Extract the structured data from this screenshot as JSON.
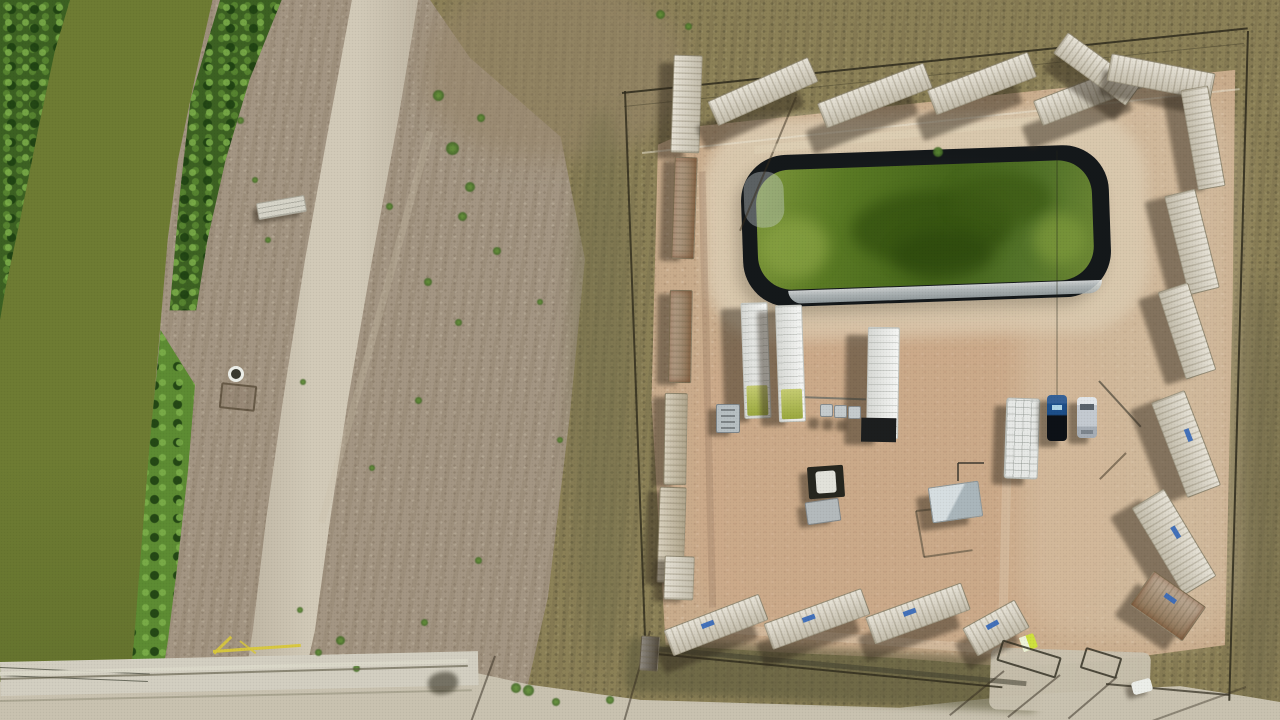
{
  "meta": {
    "description": "Aerial drone photograph, top-down view: a fenced rectangular industrial well pad on the right enclosed by tan shipping containers arranged in a sawtooth pattern, containing a black-lined retention pond of green water, white equipment trailers, a pickup truck and SUV, sheds and gates; on the left an olive-green irrigation canal bordered by vegetation, a dirt road, barren scrubby fields, a concrete bridge and a yellow gate at bottom left."
  },
  "colors": {
    "field": "#a49683",
    "scrub": "#8c8157",
    "scrub-dark": "#6f684a",
    "scrub-brown": "#97866a",
    "canal-water": "#6e7c33",
    "canal-water-dark": "#5f6e2b",
    "veg-dark": "#3c6122",
    "veg-bright": "#5d8c33",
    "road": "#c9c2b0",
    "road-light": "#d2cab8",
    "concrete": "#d3cfc1",
    "pad": "#c9ac8c",
    "pad-light": "#dbc9ae",
    "pad-pink": "#cfa887",
    "apron": "#decfb6",
    "pond-liner": "#14181a",
    "pond-water": "#46661b",
    "pond-water-light": "#8aa344",
    "pond-water-dark": "#33500f",
    "silver-liner": "#c9d0d1",
    "container-cream": "#d9d2bf",
    "container-tan": "#c5b99d",
    "container-rust": "#9c7f5e",
    "trailer-white": "#eceeea",
    "tank-green": "#9aa83e",
    "rv-white": "#e7e9e6",
    "car-blue": "#1d4f8a",
    "car-silver": "#c4cad1",
    "porta": "#cfe13e",
    "gate-yellow": "#d9c83b",
    "shed-grey": "#aab6bb",
    "equip-grey": "#c5cbcd",
    "label-blue": "#3b6cb8",
    "fence": "#2e2a1c"
  },
  "scene": {
    "objects": [
      {
        "name": "container-top-a",
        "cls": "cont vert cream",
        "x": 672,
        "y": 55,
        "w": 27,
        "h": 96,
        "rot": 2,
        "sx": -14,
        "sy": 8
      },
      {
        "name": "container-top-b",
        "cls": "cont cream",
        "x": 708,
        "y": 78,
        "w": 108,
        "h": 25,
        "rot": -24,
        "sx": -12,
        "sy": 26
      },
      {
        "name": "container-top-c",
        "cls": "cont cream",
        "x": 818,
        "y": 82,
        "w": 112,
        "h": 25,
        "rot": -21,
        "sx": -12,
        "sy": 28
      },
      {
        "name": "container-top-d",
        "cls": "cont cream",
        "x": 928,
        "y": 70,
        "w": 106,
        "h": 25,
        "rot": -21,
        "sx": -12,
        "sy": 28
      },
      {
        "name": "container-top-e",
        "cls": "cont cream",
        "x": 1034,
        "y": 80,
        "w": 110,
        "h": 25,
        "rot": -21,
        "sx": -12,
        "sy": 26
      },
      {
        "name": "container-top-f",
        "cls": "cont cream",
        "x": 1052,
        "y": 56,
        "w": 88,
        "h": 24,
        "rot": 36,
        "sx": -10,
        "sy": 18
      },
      {
        "name": "container-top-g",
        "cls": "cont cream",
        "x": 1108,
        "y": 63,
        "w": 104,
        "h": 26,
        "rot": 11,
        "sx": -8,
        "sy": 16
      },
      {
        "name": "container-right-1",
        "cls": "cont cream",
        "x": 1152,
        "y": 124,
        "w": 100,
        "h": 26,
        "rot": 80,
        "sx": -18,
        "sy": 6
      },
      {
        "name": "container-right-2",
        "cls": "cont cream",
        "x": 1141,
        "y": 226,
        "w": 100,
        "h": 30,
        "rot": 76,
        "sx": -20,
        "sy": 6
      },
      {
        "name": "container-right-3",
        "cls": "cont cream",
        "x": 1141,
        "y": 315,
        "w": 90,
        "h": 30,
        "rot": 72,
        "sx": -20,
        "sy": 8
      },
      {
        "name": "container-right-4",
        "cls": "cont cream label",
        "x": 1135,
        "y": 426,
        "w": 100,
        "h": 34,
        "rot": 69,
        "sx": -22,
        "sy": 8
      },
      {
        "name": "container-right-5",
        "cls": "cont cream label",
        "x": 1123,
        "y": 523,
        "w": 100,
        "h": 36,
        "rot": 59,
        "sx": -22,
        "sy": 10
      },
      {
        "name": "container-right-6",
        "cls": "cont rust label",
        "x": 1136,
        "y": 585,
        "w": 62,
        "h": 40,
        "rot": 35,
        "sx": -16,
        "sy": 12
      },
      {
        "name": "container-left-2",
        "cls": "cont vert rust",
        "x": 673,
        "y": 157,
        "w": 21,
        "h": 100,
        "rot": 2,
        "sx": -12,
        "sy": 4
      },
      {
        "name": "container-left-3",
        "cls": "cont vert rust",
        "x": 669,
        "y": 290,
        "w": 21,
        "h": 91,
        "rot": 1,
        "sx": -12,
        "sy": 4
      },
      {
        "name": "container-left-4",
        "cls": "cont vert tan",
        "x": 664,
        "y": 393,
        "w": 21,
        "h": 90,
        "rot": 1,
        "sx": -12,
        "sy": 4
      },
      {
        "name": "container-left-5",
        "cls": "cont vert tan",
        "x": 658,
        "y": 487,
        "w": 25,
        "h": 94,
        "rot": 2,
        "sx": -12,
        "sy": 4
      },
      {
        "name": "container-left-6",
        "cls": "cont vert cream",
        "x": 664,
        "y": 556,
        "w": 28,
        "h": 42,
        "rot": 2,
        "sx": -10,
        "sy": 4
      },
      {
        "name": "container-left-7",
        "cls": "cont vert darkc",
        "x": 640,
        "y": 636,
        "w": 17,
        "h": 33,
        "rot": 4
      },
      {
        "name": "container-bottom-1",
        "cls": "cont cream label",
        "x": 665,
        "y": 611,
        "w": 100,
        "h": 26,
        "rot": -21,
        "sx": -8,
        "sy": 20
      },
      {
        "name": "container-bottom-2",
        "cls": "cont cream label",
        "x": 765,
        "y": 605,
        "w": 102,
        "h": 26,
        "rot": -20,
        "sx": -8,
        "sy": 20
      },
      {
        "name": "container-bottom-3",
        "cls": "cont cream label",
        "x": 867,
        "y": 599,
        "w": 100,
        "h": 27,
        "rot": -20,
        "sx": -8,
        "sy": 20
      },
      {
        "name": "container-bottom-4",
        "cls": "cont cream label",
        "x": 966,
        "y": 612,
        "w": 58,
        "h": 30,
        "rot": -29,
        "sx": -8,
        "sy": 16
      },
      {
        "name": "equipment-trailer-1",
        "cls": "trailer tank",
        "x": 698,
        "y": 347,
        "w": 114,
        "h": 25,
        "rot": 88,
        "sx": -20,
        "sy": 6
      },
      {
        "name": "equipment-trailer-2",
        "cls": "trailer tank",
        "x": 732,
        "y": 350,
        "w": 115,
        "h": 25,
        "rot": 88,
        "sx": -18,
        "sy": 6
      },
      {
        "name": "equipment-trailer-3",
        "cls": "trailer darkend",
        "x": 827,
        "y": 367,
        "w": 110,
        "h": 30,
        "rot": 91,
        "sx": -22,
        "sy": 8
      },
      {
        "name": "rv-trailer",
        "cls": "rv",
        "x": 1005,
        "y": 398,
        "w": 32,
        "h": 79,
        "rot": 2,
        "sx": -12,
        "sy": 8
      },
      {
        "name": "pickup-truck",
        "cls": "pickup",
        "x": 1047,
        "y": 395,
        "w": 20,
        "h": 46,
        "rot": 0,
        "sx": -9,
        "sy": 6
      },
      {
        "name": "suv-car",
        "cls": "suv",
        "x": 1077,
        "y": 397,
        "w": 20,
        "h": 41,
        "rot": 0,
        "sx": -9,
        "sy": 6
      },
      {
        "name": "junction-box",
        "cls": "junction",
        "x": 808,
        "y": 466,
        "w": 36,
        "h": 32,
        "rot": -4,
        "sx": -8,
        "sy": 6
      },
      {
        "name": "equipment-unit",
        "cls": "unit",
        "x": 806,
        "y": 500,
        "w": 32,
        "h": 21,
        "rot": -8,
        "sx": -8,
        "sy": 5
      },
      {
        "name": "equipment-skid",
        "cls": "skid",
        "x": 716,
        "y": 404,
        "w": 22,
        "h": 27,
        "rot": 0,
        "sx": -8,
        "sy": 5
      },
      {
        "name": "metal-shed",
        "cls": "shed",
        "x": 930,
        "y": 484,
        "w": 49,
        "h": 34,
        "rot": -8,
        "sx": -12,
        "sy": 10
      },
      {
        "name": "small-tank-1",
        "cls": "tank-s",
        "x": 820,
        "y": 404,
        "w": 11,
        "h": 11,
        "rot": 0,
        "sx": -12,
        "sy": 14
      },
      {
        "name": "small-tank-2",
        "cls": "tank-s",
        "x": 834,
        "y": 405,
        "w": 11,
        "h": 11,
        "rot": 0,
        "sx": -12,
        "sy": 14
      },
      {
        "name": "small-tank-3",
        "cls": "tank-s",
        "x": 848,
        "y": 406,
        "w": 11,
        "h": 11,
        "rot": 0,
        "sx": -12,
        "sy": 14
      },
      {
        "name": "porta-potty",
        "cls": "porta",
        "x": 1021,
        "y": 635,
        "w": 15,
        "h": 15,
        "rot": -20
      },
      {
        "name": "culvert-slab",
        "cls": "slab",
        "x": 257,
        "y": 199,
        "w": 47,
        "h": 15,
        "rot": -10,
        "sx": -4,
        "sy": 6
      },
      {
        "name": "culvert-ring",
        "cls": "ring",
        "x": 228,
        "y": 366,
        "w": 10,
        "h": 10,
        "rot": 0
      },
      {
        "name": "livestock-pen",
        "cls": "pen",
        "x": 220,
        "y": 384,
        "w": 32,
        "h": 22,
        "rot": 6
      },
      {
        "name": "white-car-south",
        "cls": "whitecar",
        "x": 1132,
        "y": 680,
        "w": 20,
        "h": 13,
        "rot": -15,
        "sx": -6,
        "sy": 4
      },
      {
        "name": "culvert-shadow",
        "cls": "darkpatch",
        "x": 428,
        "y": 672,
        "w": 30,
        "h": 22,
        "rot": -10
      },
      {
        "name": "entrance-gate-left",
        "cls": "gate",
        "x": 998,
        "y": 648,
        "w": 58,
        "h": 18,
        "rot": 17
      },
      {
        "name": "entrance-gate-right",
        "cls": "gate",
        "x": 1082,
        "y": 652,
        "w": 34,
        "h": 18,
        "rot": 17
      }
    ],
    "lines": [
      {
        "name": "fence-north",
        "x": 622,
        "y": 92,
        "len": 629,
        "rot": -5.9,
        "w": 2,
        "color": "#2e2a1c",
        "op": 0.85
      },
      {
        "name": "fence-north-inner",
        "x": 624,
        "y": 106,
        "len": 623,
        "rot": -5.8,
        "w": 1,
        "color": "#2e2a1c",
        "op": 0.35
      },
      {
        "name": "track-inner-north",
        "x": 642,
        "y": 152,
        "len": 601,
        "rot": -6.1,
        "w": 2,
        "color": "#ebe6d4",
        "op": 0.5
      },
      {
        "name": "fence-west",
        "x": 625,
        "y": 90,
        "len": 566,
        "rot": 87.9,
        "w": 2,
        "color": "#2e2a1c",
        "op": 0.8
      },
      {
        "name": "fence-east",
        "x": 1248,
        "y": 30,
        "len": 670,
        "rot": 91.6,
        "w": 2,
        "color": "#2e2a1c",
        "op": 0.85
      },
      {
        "name": "fence-south-left",
        "x": 646,
        "y": 652,
        "len": 358,
        "rot": 5.5,
        "w": 2,
        "color": "#2e2a1c",
        "op": 0.8
      },
      {
        "name": "fence-south-right",
        "x": 1106,
        "y": 683,
        "len": 124,
        "rot": 5.1,
        "w": 2,
        "color": "#2e2a1c",
        "op": 0.7
      },
      {
        "name": "south-pipe",
        "x": 654,
        "y": 646,
        "len": 374,
        "rot": 5.4,
        "w": 5,
        "color": "#423f2f",
        "op": 0.55
      },
      {
        "name": "guy-cable",
        "x": 1057,
        "y": 150,
        "len": 284,
        "rot": 90,
        "w": 1,
        "color": "#23251a",
        "op": 0.5
      },
      {
        "name": "pole-shadow-north",
        "x": 796,
        "y": 96,
        "len": 145,
        "rot": 112.7,
        "w": 2,
        "color": "#372d1e",
        "op": 0.5
      },
      {
        "name": "pole-shadow-cars",
        "x": 1126,
        "y": 452,
        "len": 37,
        "rot": 135,
        "w": 2,
        "color": "#372d1e",
        "op": 0.5
      },
      {
        "name": "pipe-northeast",
        "x": 1099,
        "y": 380,
        "len": 62,
        "rot": 47.6,
        "w": 2,
        "color": "#35332a",
        "op": 0.6
      },
      {
        "name": "gate-shadow-1",
        "x": 1004,
        "y": 670,
        "len": 70,
        "rot": 140.8,
        "w": 2,
        "color": "#322a1e",
        "op": 0.5
      },
      {
        "name": "gate-shadow-2",
        "x": 1060,
        "y": 674,
        "len": 67,
        "rot": 141,
        "w": 2,
        "color": "#322a1e",
        "op": 0.5
      },
      {
        "name": "gate-shadow-3",
        "x": 1117,
        "y": 676,
        "len": 64,
        "rot": 139.4,
        "w": 2,
        "color": "#322a1e",
        "op": 0.5
      },
      {
        "name": "gate-shadow-4",
        "x": 1246,
        "y": 686,
        "len": 100,
        "rot": 160.1,
        "w": 2,
        "color": "#322a1e",
        "op": 0.4
      },
      {
        "name": "pole-shadow-road-1",
        "x": 495,
        "y": 655,
        "len": 70,
        "rot": 110,
        "w": 2,
        "color": "#322a1e",
        "op": 0.5
      },
      {
        "name": "pole-shadow-road-2",
        "x": 650,
        "y": 630,
        "len": 95,
        "rot": 106,
        "w": 2,
        "color": "#322a1e",
        "op": 0.5
      },
      {
        "name": "power-line-1",
        "x": 0,
        "y": 667,
        "len": 150,
        "rot": 2.5,
        "w": 1,
        "color": "#232719",
        "op": 0.6
      },
      {
        "name": "power-line-2",
        "x": 0,
        "y": 675,
        "len": 148,
        "rot": 2.3,
        "w": 1,
        "color": "#232719",
        "op": 0.6
      },
      {
        "name": "bridge-guardrail-light",
        "x": 0,
        "y": 672,
        "len": 468,
        "rot": -1.6,
        "w": 4,
        "color": "#dcd8ca",
        "op": 0.9
      },
      {
        "name": "bridge-guardrail-dark",
        "x": 0,
        "y": 678,
        "len": 468,
        "rot": -1.6,
        "w": 2,
        "color": "#5c5742",
        "op": 0.6
      },
      {
        "name": "bridge-edge",
        "x": 0,
        "y": 700,
        "len": 472,
        "rot": -1.3,
        "w": 2,
        "color": "#97927f",
        "op": 0.6
      },
      {
        "name": "yellow-gate-bar",
        "x": 213,
        "y": 650,
        "len": 88,
        "rot": -4,
        "w": 3,
        "color": "#d9c83b",
        "op": 0.95
      },
      {
        "name": "yellow-gate-arm-1",
        "x": 214,
        "y": 652,
        "len": 24,
        "rot": -44,
        "w": 3,
        "color": "#d9c83b",
        "op": 0.9
      },
      {
        "name": "yellow-gate-arm-2",
        "x": 240,
        "y": 640,
        "len": 20,
        "rot": 38,
        "w": 2,
        "color": "#d9c83b",
        "op": 0.8
      },
      {
        "name": "field-trail",
        "x": 430,
        "y": 128,
        "len": 406,
        "rot": 105.5,
        "w": 7,
        "color": "#cdc3ac",
        "op": 0.28
      },
      {
        "name": "pad-track-north",
        "x": 754,
        "y": 146,
        "len": 327,
        "rot": -6,
        "w": 8,
        "color": "#e4d6bc",
        "op": 0.4
      },
      {
        "name": "pad-track-south",
        "x": 700,
        "y": 622,
        "len": 302,
        "rot": 4.5,
        "w": 9,
        "color": "#e4d6bc",
        "op": 0.33
      },
      {
        "name": "pad-track-gate",
        "x": 1002,
        "y": 652,
        "len": 235,
        "rot": -88.5,
        "w": 9,
        "color": "#e0d2b8",
        "op": 0.33
      },
      {
        "name": "pad-track-west",
        "x": 702,
        "y": 168,
        "len": 436,
        "rot": 88.6,
        "w": 7,
        "color": "#96785f",
        "op": 0.3
      },
      {
        "name": "shed-frame-1",
        "x": 916,
        "y": 510,
        "len": 52,
        "rot": -6,
        "w": 2,
        "color": "#3f3b2e",
        "op": 0.5
      },
      {
        "name": "shed-frame-2",
        "x": 916,
        "y": 510,
        "len": 47,
        "rot": 80,
        "w": 2,
        "color": "#3f3b2e",
        "op": 0.5
      },
      {
        "name": "shed-frame-3",
        "x": 924,
        "y": 556,
        "len": 49,
        "rot": -8,
        "w": 2,
        "color": "#3f3b2e",
        "op": 0.5
      },
      {
        "name": "l-pipe-1",
        "x": 958,
        "y": 462,
        "len": 26,
        "rot": 0,
        "w": 2,
        "color": "#33312a",
        "op": 0.7
      },
      {
        "name": "l-pipe-2",
        "x": 958,
        "y": 462,
        "len": 18,
        "rot": 90,
        "w": 2,
        "color": "#33312a",
        "op": 0.7
      },
      {
        "name": "manifold-pipe",
        "x": 798,
        "y": 396,
        "len": 68,
        "rot": 2,
        "w": 2,
        "color": "#6b6e66",
        "op": 0.8
      }
    ],
    "bushes": [
      [
        438,
        95,
        11
      ],
      [
        452,
        148,
        13
      ],
      [
        470,
        187,
        10
      ],
      [
        481,
        118,
        8
      ],
      [
        462,
        216,
        9
      ],
      [
        497,
        251,
        8
      ],
      [
        389,
        206,
        7
      ],
      [
        428,
        282,
        8
      ],
      [
        458,
        322,
        7
      ],
      [
        540,
        302,
        6
      ],
      [
        418,
        400,
        7
      ],
      [
        372,
        468,
        6
      ],
      [
        303,
        382,
        6
      ],
      [
        478,
        560,
        7
      ],
      [
        340,
        640,
        9
      ],
      [
        424,
        622,
        7
      ],
      [
        516,
        688,
        10
      ],
      [
        560,
        440,
        6
      ],
      [
        528,
        690,
        11
      ],
      [
        556,
        702,
        8
      ],
      [
        610,
        700,
        8
      ],
      [
        318,
        652,
        7
      ],
      [
        356,
        668,
        7
      ],
      [
        300,
        610,
        6
      ],
      [
        660,
        14,
        9
      ],
      [
        688,
        26,
        7
      ],
      [
        240,
        120,
        7
      ],
      [
        255,
        180,
        6
      ],
      [
        268,
        240,
        6
      ],
      [
        938,
        152,
        10
      ]
    ]
  }
}
